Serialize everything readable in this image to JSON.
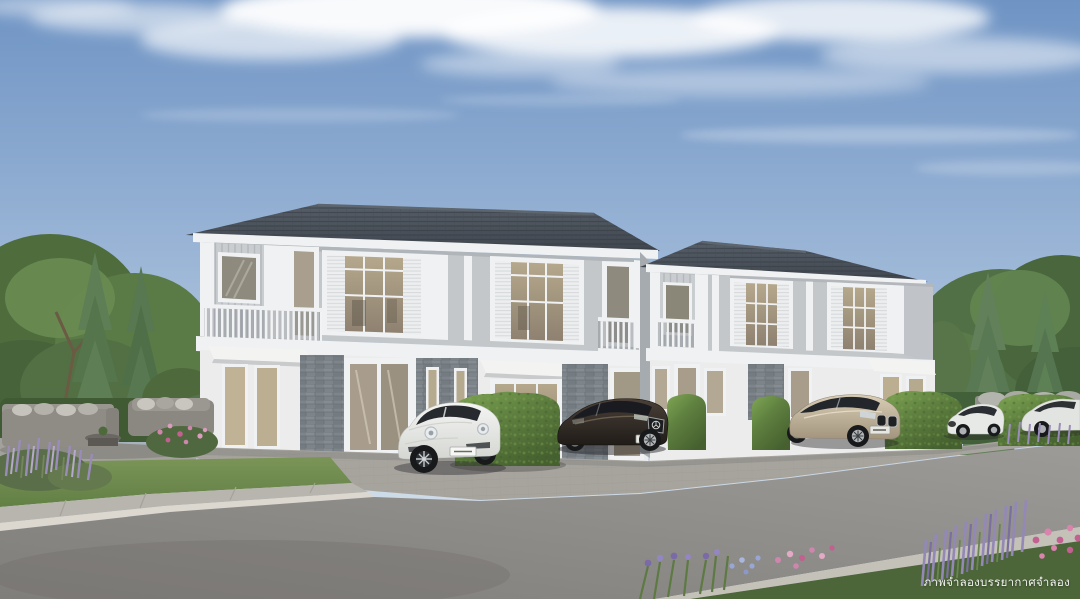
{
  "scene": {
    "type": "3d-architectural-rendering",
    "subject": "Row of modern two-storey townhouses with dark hip roofs, white trim, shuttered windows and balconies; four cars parked in front behind trimmed hedges",
    "time_of_day": "daytime, blue sky with wispy clouds",
    "watermark": {
      "text": "ภาพจำลองบรรยากาศจำลอง",
      "color": "#ffffff"
    }
  },
  "buildings": {
    "left_block": {
      "label": "townhouse block (front)",
      "storeys": 2,
      "features": "balconies, louvered shutters, stone-veneer ground floor, awnings"
    },
    "right_block": {
      "label": "townhouse block (set back)",
      "storeys": 2,
      "features": "balconies, louvered shutters, awnings"
    }
  },
  "cars": [
    {
      "id": "porsche",
      "label": "white sports coupe",
      "body_color": "#eef0ee"
    },
    {
      "id": "mercedes",
      "label": "dark brown luxury coupe",
      "body_color": "#2e2822"
    },
    {
      "id": "bmw",
      "label": "champagne sports sedan",
      "body_color": "#c2b49b"
    },
    {
      "id": "sports",
      "label": "white sports car behind hedge",
      "body_color": "#e7e9e6"
    },
    {
      "id": "edge",
      "label": "white car at right edge (partial)",
      "body_color": "#e2e4e1"
    }
  ],
  "vegetation": {
    "left": "leafy trees, two conifers, hedge row, lavender bush, pink flowers",
    "right": "conifers, leafy trees, hedges, bench wall with cushions",
    "foreground_right": "flower bed with iris, plumbago, pink blooms and lavender spikes"
  },
  "furniture": {
    "patio": "grey outdoor sofa set with light cushions and coffee table"
  },
  "colors": {
    "sky_top": "#6f94c4",
    "sky_mid": "#9db7d7",
    "sky_low": "#c6d5e5",
    "sky_horizon": "#dde6ee",
    "cloud": "#ffffff",
    "roof": "#40464e",
    "roof_line": "#343b42",
    "ridge": "#5d656e",
    "trim": "#f0f1f2",
    "wall": "#c3c7ca",
    "siding": "#c9cdd0",
    "ground_wall": "#ebeceb",
    "stone": "#7d848a",
    "stone_dark": "#6b7177",
    "glass_warm": "#b5a88c",
    "glass_warm_dark": "#8e8170",
    "glass_dark": "#26292d",
    "hedge": "#5f8040",
    "hedge_light": "#7fa653",
    "hedge_dark": "#46612f",
    "tree": "#527045",
    "tree_dark": "#47633a",
    "conifer": "#5e7f55",
    "grass": "#6f8b4e",
    "grass_dark": "#627f45",
    "paver": "#a7a49e",
    "sidewalk": "#b8b5ae",
    "curb": "#dcd8d0",
    "asphalt": "#807e7a",
    "asphalt_light": "#9d9b97",
    "patio": "#a3a19c",
    "sofa": "#8f8c85",
    "cushion": "#c6c3bc",
    "lavender": "#9a8cb8",
    "iris": "#7a6aa8",
    "plumbago": "#98a6d6",
    "pink": "#cf86ae",
    "magenta": "#c2608f",
    "car_white": "#f4f5f3",
    "car_dark_top": "#4a4038",
    "car_dark": "#201c18",
    "car_champagne": "#d9cdb6",
    "car_champagne_dark": "#a3957d",
    "tire": "#17191b",
    "rim_silver": "#c7cacc"
  }
}
